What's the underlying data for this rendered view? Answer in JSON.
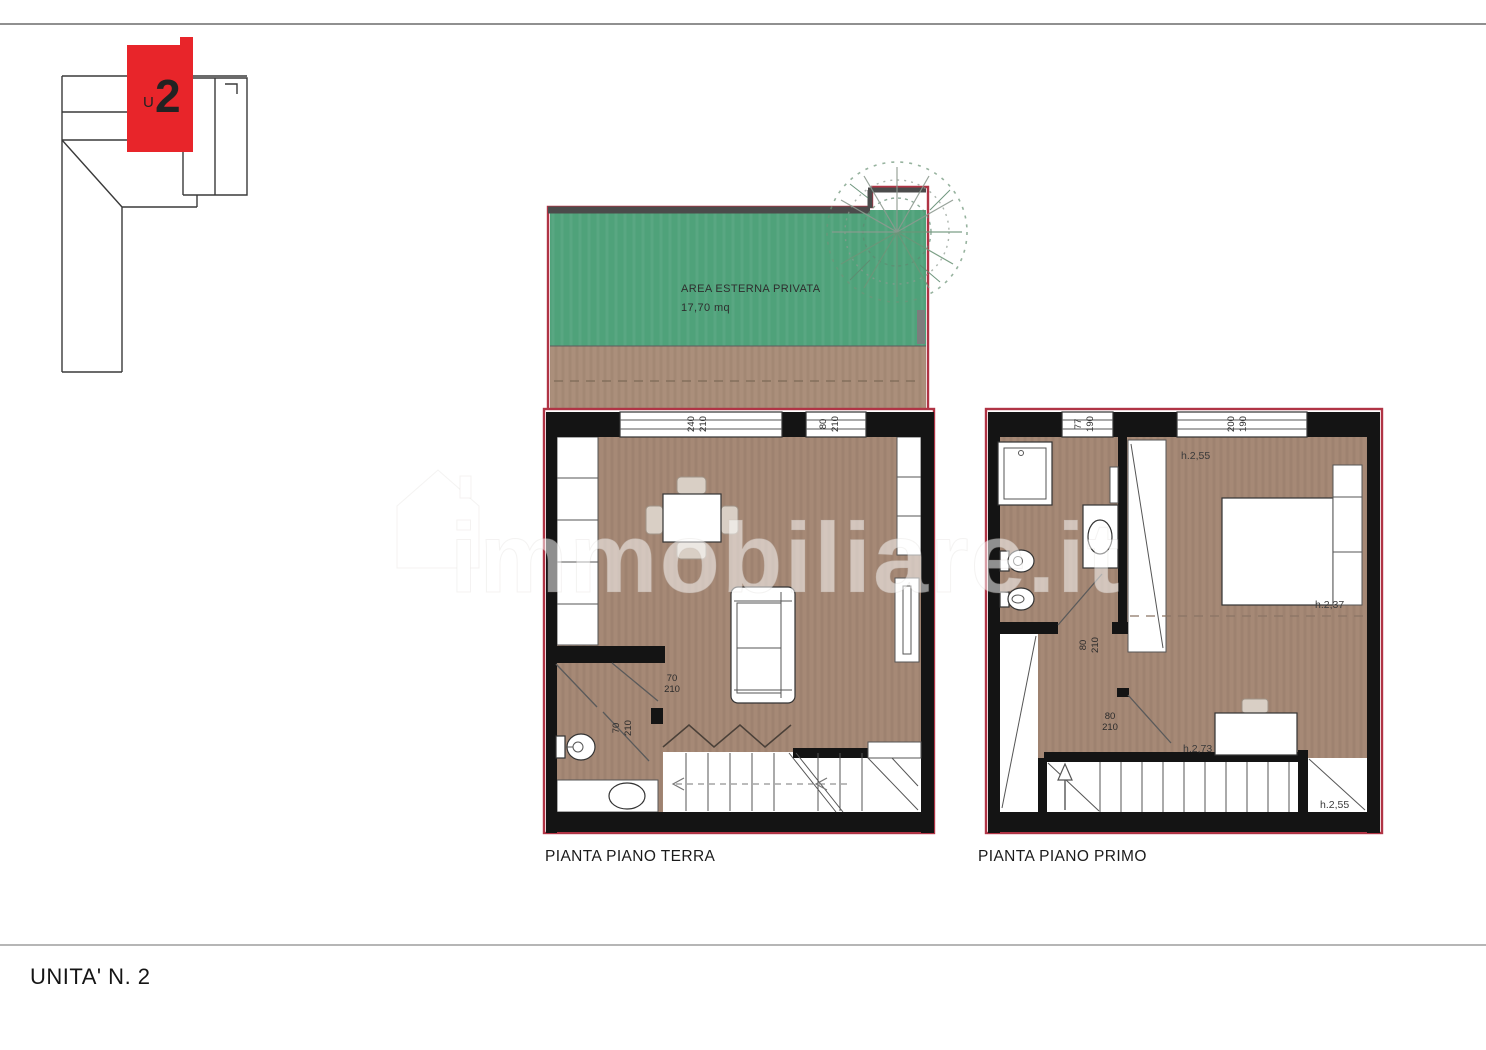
{
  "page": {
    "footer_label": "UNITA' N. 2",
    "watermark_text": "immobiliare.it"
  },
  "key_plan": {
    "unit_prefix": "U",
    "unit_number": "2"
  },
  "terrace": {
    "label": "AREA ESTERNA PRIVATA",
    "area": "17,70 mq"
  },
  "ground_floor": {
    "caption": "PIANTA PIANO TERRA",
    "window_main_w": "240",
    "window_main_h": "210",
    "window_small_w": "80",
    "window_small_h": "210",
    "door_hall_w": "70",
    "door_hall_h": "210",
    "door_bath_w": "70",
    "door_bath_h": "210"
  },
  "first_floor": {
    "caption": "PIANTA PIANO PRIMO",
    "window_bath_w": "77",
    "window_bath_h": "190",
    "window_bed_w": "200",
    "window_bed_h": "190",
    "door_bath_w": "80",
    "door_bath_h": "210",
    "door_stairs_w": "80",
    "door_stairs_h": "210",
    "height_bedroom": "h.2,55",
    "height_bed_side": "h.2,37",
    "height_stairs": "h.2,73",
    "height_landing": "h.2,55"
  },
  "colors": {
    "accent_red": "#e8252a",
    "outline_red": "#b03445",
    "grass_green": "#4fa27a",
    "floor_brown": "#a68976",
    "pave_brown": "#ab8f7b",
    "wall_black": "#141414",
    "terrace_wall_gray": "#4b4b4b"
  }
}
